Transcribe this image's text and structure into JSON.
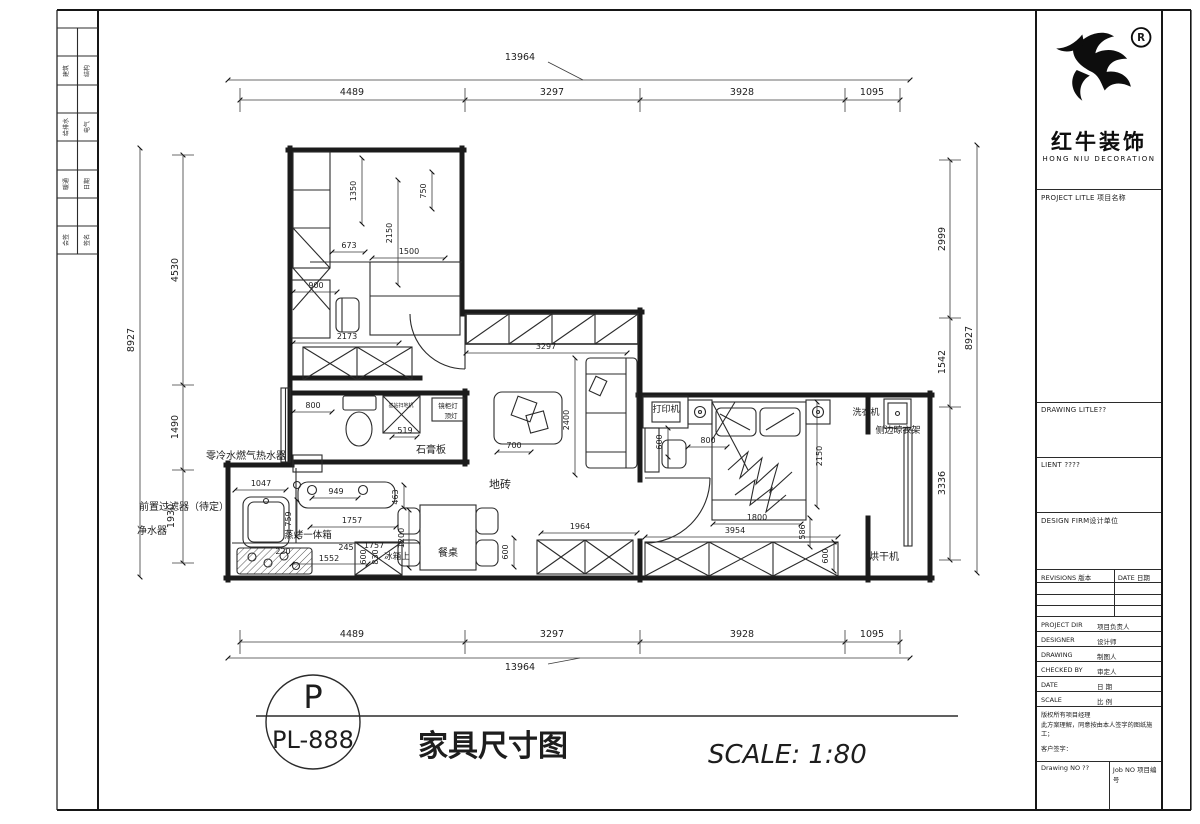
{
  "frame": {
    "side_strip_cells": [
      [
        "建筑",
        "结构"
      ],
      [
        "给排水",
        "电气"
      ],
      [
        "暖通",
        "日期"
      ],
      [
        "会签",
        "签名"
      ]
    ]
  },
  "logo": {
    "cn": "红牛装饰",
    "en": "HONG NIU DECORATION",
    "registered": "R"
  },
  "title_block": {
    "project_label": "PROJECT LITLE  项目名称",
    "drawing_label": "DRAWING LITLE??",
    "client_label": "LIENT ????",
    "firm_label": "DESIGN FIRM设计单位",
    "revisions_label": "REVISIONS 版本",
    "date_label": "DATE 日期",
    "rows": [
      {
        "label": "PROJECT DIR",
        "value": "项目负责人"
      },
      {
        "label": "DESIGNER",
        "value": "设计师"
      },
      {
        "label": "DRAWING",
        "value": "制图人"
      },
      {
        "label": "CHECKED BY",
        "value": "审定人"
      },
      {
        "label": "DATE",
        "value": "日 期"
      },
      {
        "label": "SCALE",
        "value": "比 例"
      }
    ],
    "copyright_line1": "版权所有项目经理",
    "copyright_line2": "此方案理解，同意按由本人签字的图纸施工；",
    "copyright_line3": "客户签字：",
    "drawing_no_label": "Drawing NO ??",
    "job_no_label": "Job NO 项目编号"
  },
  "sheet": {
    "circle_letter": "P",
    "circle_number": "PL-888",
    "title": "家具尺寸图",
    "scale": "SCALE: 1:80"
  },
  "plan": {
    "dims": {
      "top_total": "13964",
      "top_1": "4489",
      "top_2": "3297",
      "top_3": "3928",
      "top_4": "1095",
      "bottom_total": "13964",
      "bottom_1": "4489",
      "bottom_2": "3297",
      "bottom_3": "3928",
      "bottom_4": "1095",
      "left_total": "8927",
      "left_1": "4530",
      "left_2": "1490",
      "left_3": "1930",
      "right_total": "8927",
      "right_1": "2999",
      "right_2": "1542",
      "right_3": "3336",
      "study_1350": "1350",
      "study_750": "750",
      "study_673": "673",
      "study_2150": "2150",
      "study_1500": "1500",
      "study_900": "900",
      "study_2173": "2173",
      "bath_800": "800",
      "bath_519": "519",
      "kitchen_1047": "1047",
      "kitchen_949": "949",
      "kitchen_759": "759",
      "kitchen_1757a": "1757",
      "kitchen_463": "463",
      "kitchen_245": "245",
      "kitchen_1757b": "1757",
      "kitchen_1552": "1552",
      "kitchen_220": "220",
      "kitchen_830": "830",
      "kitchen_600": "600",
      "kitchen_1200": "1200",
      "hall_600": "600",
      "hall_3297": "3297",
      "living_700": "700",
      "living_2400": "2400",
      "living_1964": "1964",
      "bed_600": "600",
      "bed_800": "800",
      "bed_2150": "2150",
      "bed_1800": "1800",
      "bed_586": "586",
      "bed_3954": "3954",
      "wardrobe_600": "600"
    },
    "labels": {
      "water_heater": "零冷水燃气热水器",
      "prefilter": "前置过滤器（待定）",
      "purifier": "净水器",
      "steam_oven": "蒸烤一体箱",
      "fridge": "冰箱上",
      "dining_table": "餐桌",
      "plasterboard": "石膏板",
      "floor_tile": "地砖",
      "mirror_light": "镜柜灯",
      "ceiling_light": "顶灯",
      "vacuum_base": "基站扫地机",
      "printer": "打印机",
      "washer": "洗衣机",
      "drying_rack": "侧边晾衣架",
      "dryer": "烘干机"
    }
  }
}
